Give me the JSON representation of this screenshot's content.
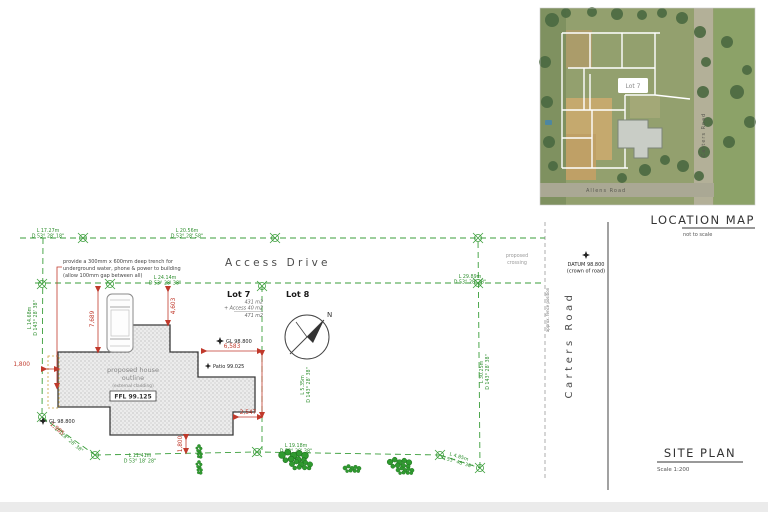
{
  "loc": {
    "title": "LOCATION MAP",
    "not_to_scale": "not to scale",
    "lot7": "Lot 7",
    "carters": "Carters Road",
    "allens": "Allens Road"
  },
  "title": {
    "site_plan": "SITE PLAN",
    "scale": "Scale 1:200"
  },
  "plan": {
    "access_drive": "Access Drive",
    "carters_road": "Carters Road",
    "fence_note": "approx. fence position",
    "north": "N",
    "lot7": {
      "name": "Lot 7",
      "area": "431 m2",
      "access": "+ Access 40 m2",
      "total": "471 m2"
    },
    "lot8": "Lot 8"
  },
  "note": {
    "l1": "provide a 300mm x 600mm deep trench for",
    "l2": "underground water, phone & power to building",
    "l3": "(allow 100mm gap between all)"
  },
  "crossing": {
    "l1": "proposed",
    "l2": "crossing"
  },
  "datum": {
    "l1": "DATUM 98.800",
    "l2": "(crown of road)"
  },
  "levels": {
    "gl_top": "GL 98.800",
    "gl_bottom": "GL 98.800",
    "patio": "Patio 99.025",
    "ffl": "FFL 99.125"
  },
  "house": {
    "l1": "proposed house",
    "l2": "outline",
    "l3": "(external cladding)"
  },
  "red": {
    "d7689": "7,689",
    "d4603": "4,603",
    "d6583": "6,583",
    "d2547": "2,547",
    "d1800_left": "1,800",
    "d1800_bottom": "1,800",
    "d1985": "1,985"
  },
  "b": {
    "top1_l": "L 17.27m",
    "top1_d": "D 53° 28' 18\"",
    "top2_l": "L 20.56m",
    "top2_d": "D 53° 28' 58\"",
    "access1_l": "L 24.14m",
    "access1_d": "D 53° 28' 38\"",
    "access2_l": "L 29.89m",
    "access2_d": "D 53° 28' 38\"",
    "left_l": "L 14.68m",
    "left_d": "D 143° 28' 38\"",
    "diag_bl_d": "D 128° 28' 38\"",
    "bottom1_l": "L 11.41m",
    "bottom1_d": "D 53° 18' 28\"",
    "bottom2_l": "L 19.18m",
    "bottom2_d": "D 53° 28' 38\"",
    "diag_br_l": "L 4.85m",
    "diag_br_d": "D 53° 48' 38\"",
    "right_l": "L 30.25m",
    "right_d": "D 143° 28' 38\"",
    "lotline_l": "L 5.35m",
    "lotline_d": "D 143° 28' 38\""
  },
  "colors": {
    "boundary_green": "#3a9e3a",
    "dim_red": "#c0392b",
    "ink": "#333333",
    "grey": "#8a8a8a"
  }
}
